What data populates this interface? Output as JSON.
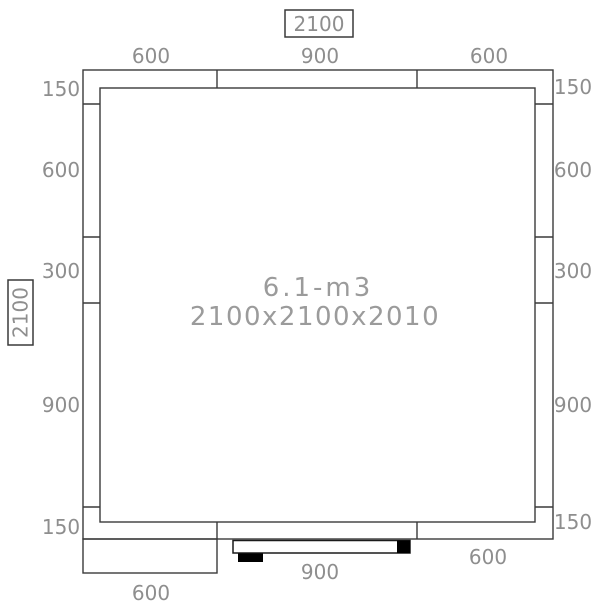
{
  "room_plan": {
    "center_label": {
      "volume": "6.1-m3",
      "dimensions": "2100x2100x2010"
    },
    "overall": {
      "width_label": "2100",
      "height_label": "2100"
    },
    "top_segments": [
      "600",
      "900",
      "600"
    ],
    "left_segments": [
      "150",
      "600",
      "300",
      "900",
      "150"
    ],
    "right_segments": [
      "150",
      "600",
      "300",
      "900",
      "150"
    ],
    "bottom": {
      "door_width_label": "900",
      "left_panel_label": "600",
      "right_segment_label": "600"
    },
    "colors": {
      "wall_line": "#3a3a3a",
      "dimension_text": "#8e8e8e",
      "center_text": "#9b9b9b",
      "door_hardware": "#000000",
      "background": "#ffffff"
    }
  }
}
